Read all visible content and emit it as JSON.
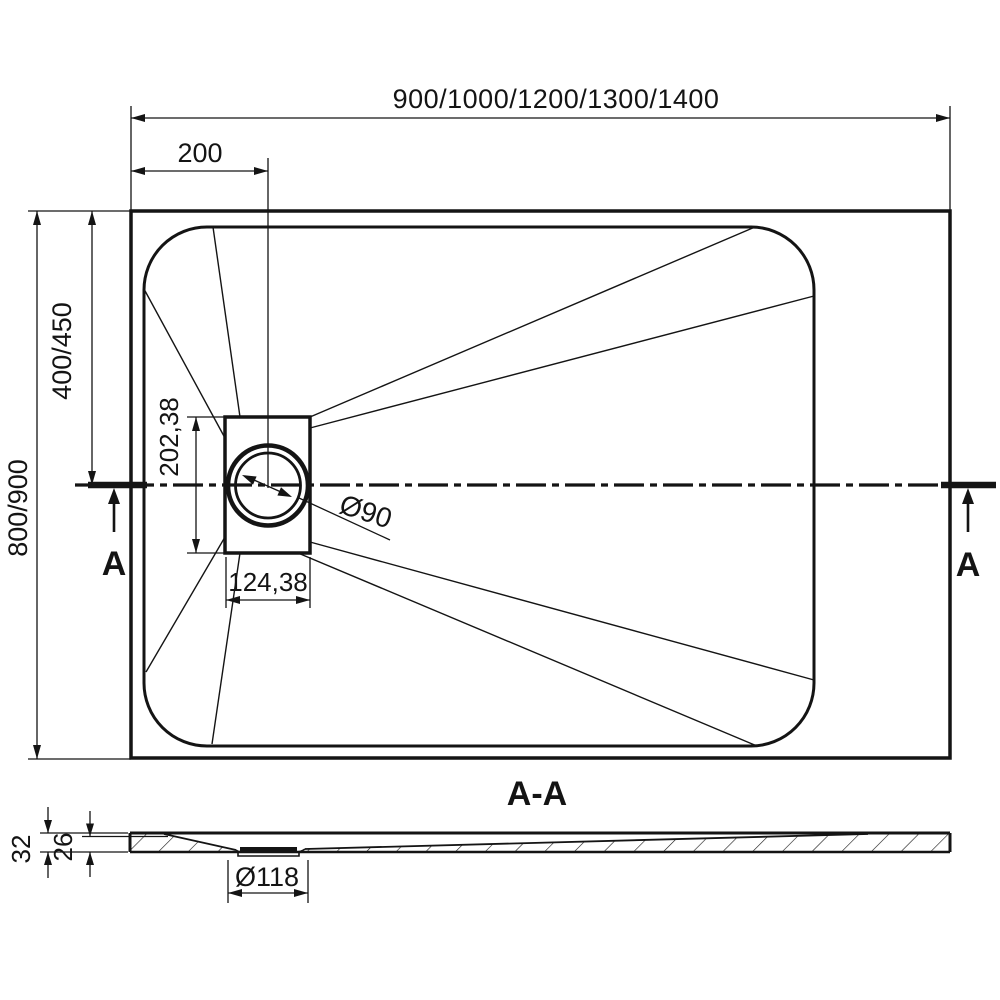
{
  "drawing": {
    "type": "technical-drawing",
    "subject": "rectangular shower tray with offset drain, top view and cross section",
    "colors": {
      "line": "#141414",
      "background": "#ffffff"
    },
    "dimensions": {
      "overall_width": "900/1000/1200/1300/1400",
      "drain_offset_x": "200",
      "drain_offset_y": "400/450",
      "overall_depth": "800/900",
      "drain_box_height": "202,38",
      "drain_box_width": "124,38",
      "drain_diameter": "Ø90",
      "tray_thickness": "32",
      "edge_thickness": "26",
      "outlet_diameter": "Ø118"
    },
    "section": {
      "label": "A-A",
      "marker_left": "A",
      "marker_right": "A"
    }
  }
}
